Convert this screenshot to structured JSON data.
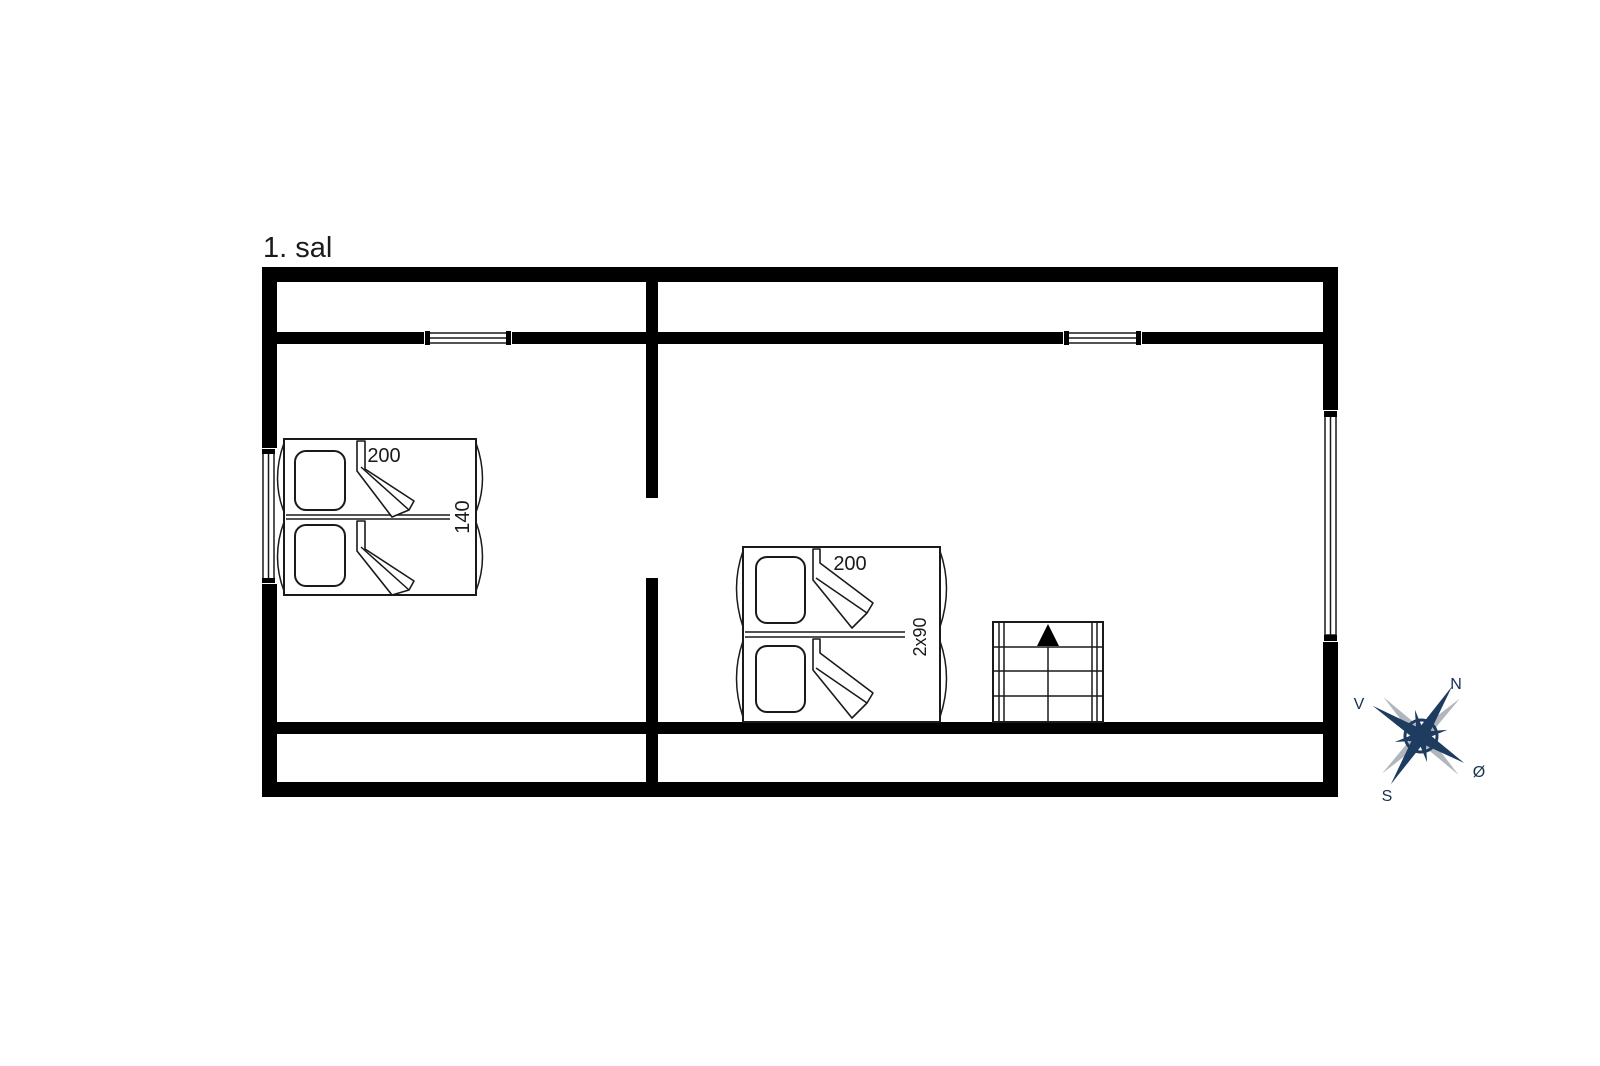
{
  "floor_plan": {
    "floor_label": "1. sal",
    "beds": [
      {
        "id": "double-bed-140",
        "size_length": "200",
        "size_width": "140"
      },
      {
        "id": "twin-bed-2x90",
        "size_length": "200",
        "size_width": "2x90"
      }
    ],
    "compass": {
      "north": "N",
      "west": "V",
      "south": "S",
      "east": "Ø"
    },
    "colors": {
      "wall": "#000000",
      "line": "#1a1a1a",
      "compass_primary": "#1d3c5f",
      "compass_secondary": "#b0b6bd"
    }
  }
}
